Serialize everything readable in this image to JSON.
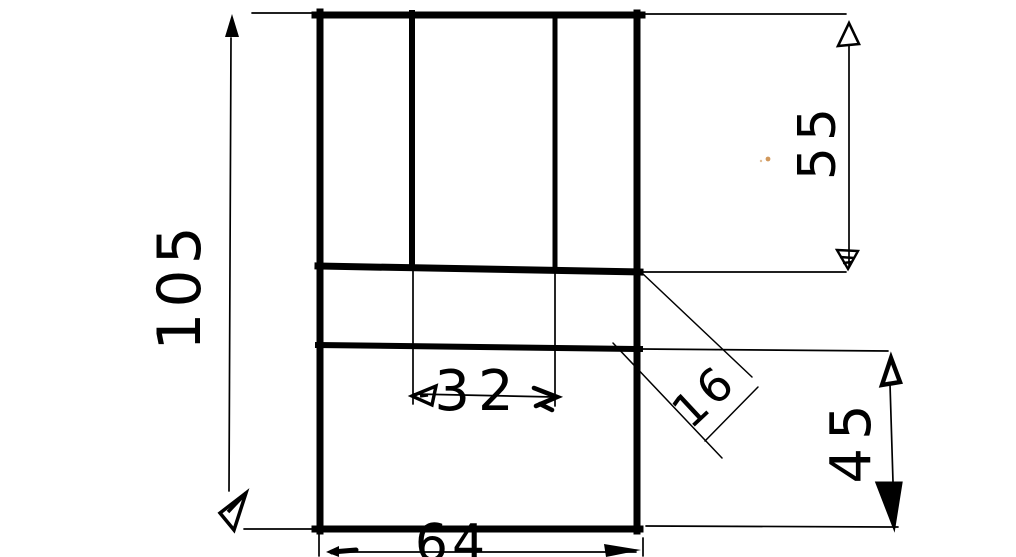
{
  "canvas": {
    "background": "#ffffff",
    "ink_color": "#000000",
    "stray_mark_color": "#c9863f"
  },
  "dimensions": {
    "overall_height": {
      "value": "105"
    },
    "upper_section_height": {
      "value": "55"
    },
    "slot_width": {
      "value": "32"
    },
    "mid_band_height": {
      "value": "16"
    },
    "lower_section_height": {
      "value": "45"
    },
    "overall_width": {
      "value": "64"
    }
  }
}
